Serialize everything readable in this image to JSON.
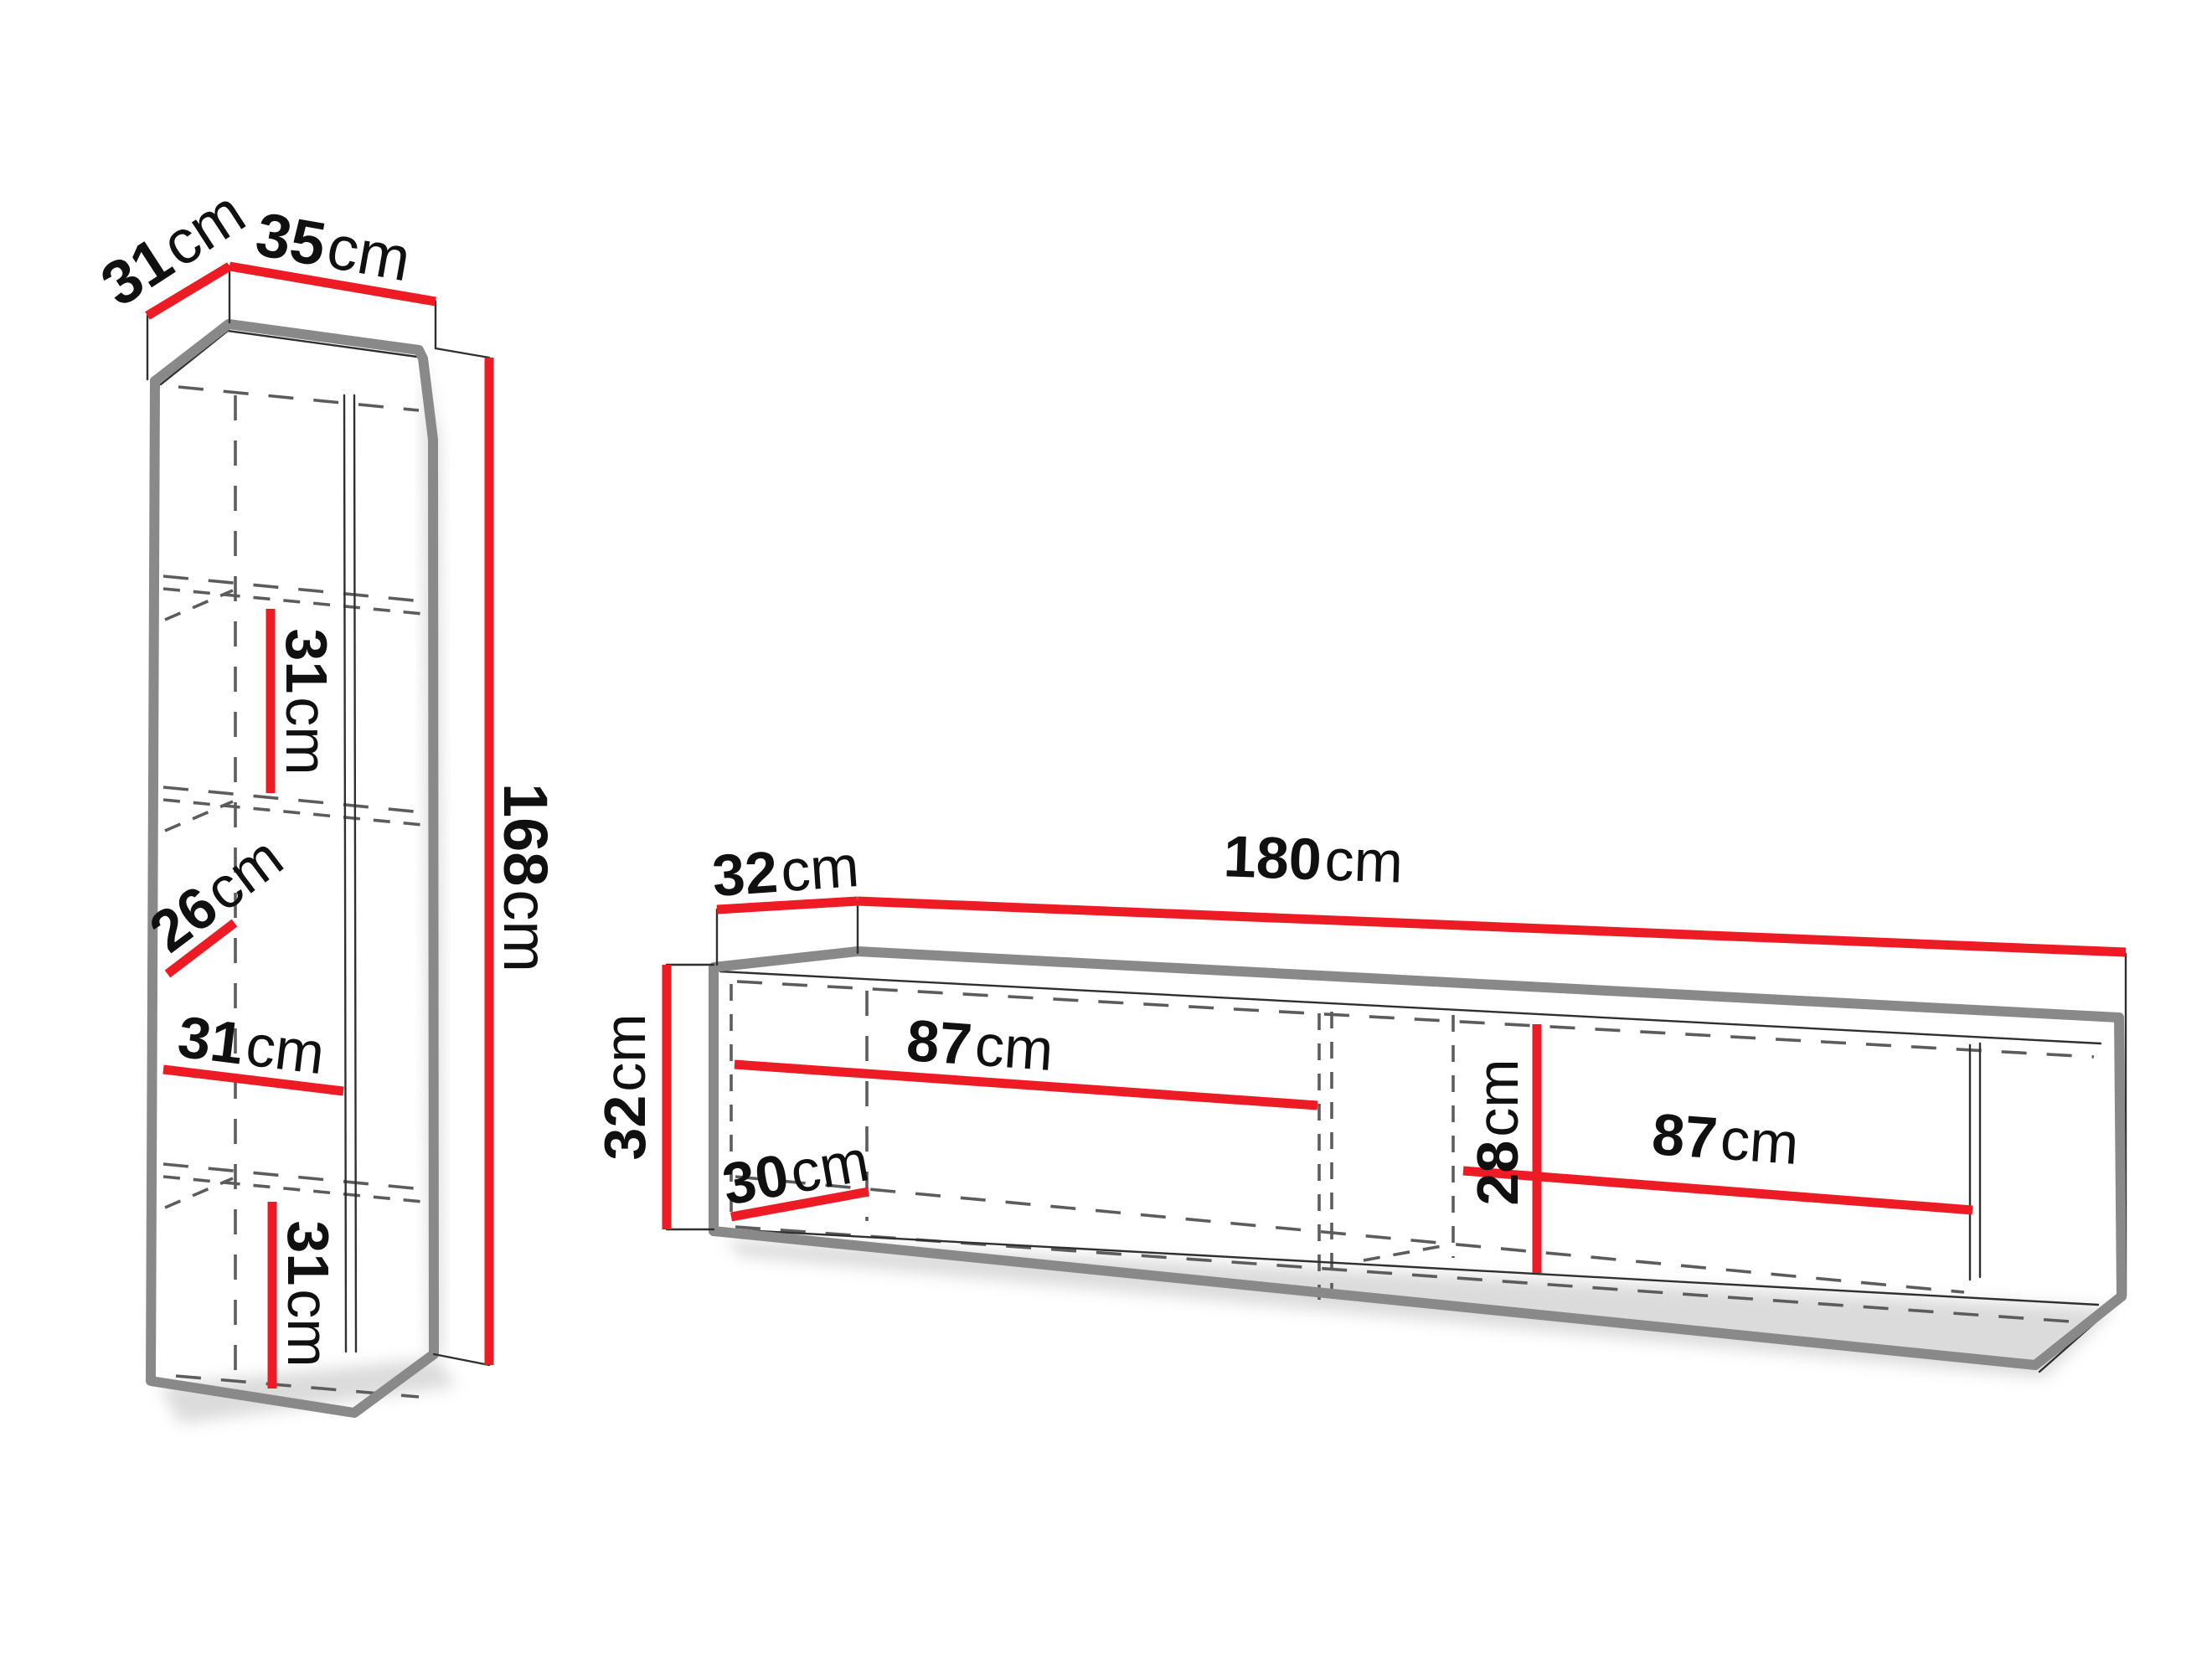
{
  "page": {
    "title": "Furniture set dimensions diagram",
    "background": "#ffffff"
  },
  "colors": {
    "dimension_red": "#ed1c24",
    "cabinet_outline_gray": "#898989",
    "thin_line_dark": "#2f2f2f",
    "dashed_gray": "#5c5c5c",
    "label_black": "#101010"
  },
  "left_cabinet": {
    "name": "tall wall cabinet",
    "dimensions": {
      "depth": {
        "value": "31",
        "unit": "cm"
      },
      "width": {
        "value": "35",
        "unit": "cm"
      },
      "height": {
        "value": "168",
        "unit": "cm"
      },
      "shelf_top_height": {
        "value": "31",
        "unit": "cm"
      },
      "shelf_mid_depth": {
        "value": "26",
        "unit": "cm"
      },
      "shelf_mid_width": {
        "value": "31",
        "unit": "cm"
      },
      "shelf_bottom_height": {
        "value": "31",
        "unit": "cm"
      }
    }
  },
  "right_cabinet": {
    "name": "wall-mounted TV stand",
    "dimensions": {
      "depth": {
        "value": "32",
        "unit": "cm"
      },
      "width": {
        "value": "180",
        "unit": "cm"
      },
      "height": {
        "value": "32",
        "unit": "cm"
      },
      "inner_left_width": {
        "value": "87",
        "unit": "cm"
      },
      "inner_depth": {
        "value": "30",
        "unit": "cm"
      },
      "inner_height": {
        "value": "28",
        "unit": "cm"
      },
      "inner_right_width": {
        "value": "87",
        "unit": "cm"
      }
    }
  }
}
